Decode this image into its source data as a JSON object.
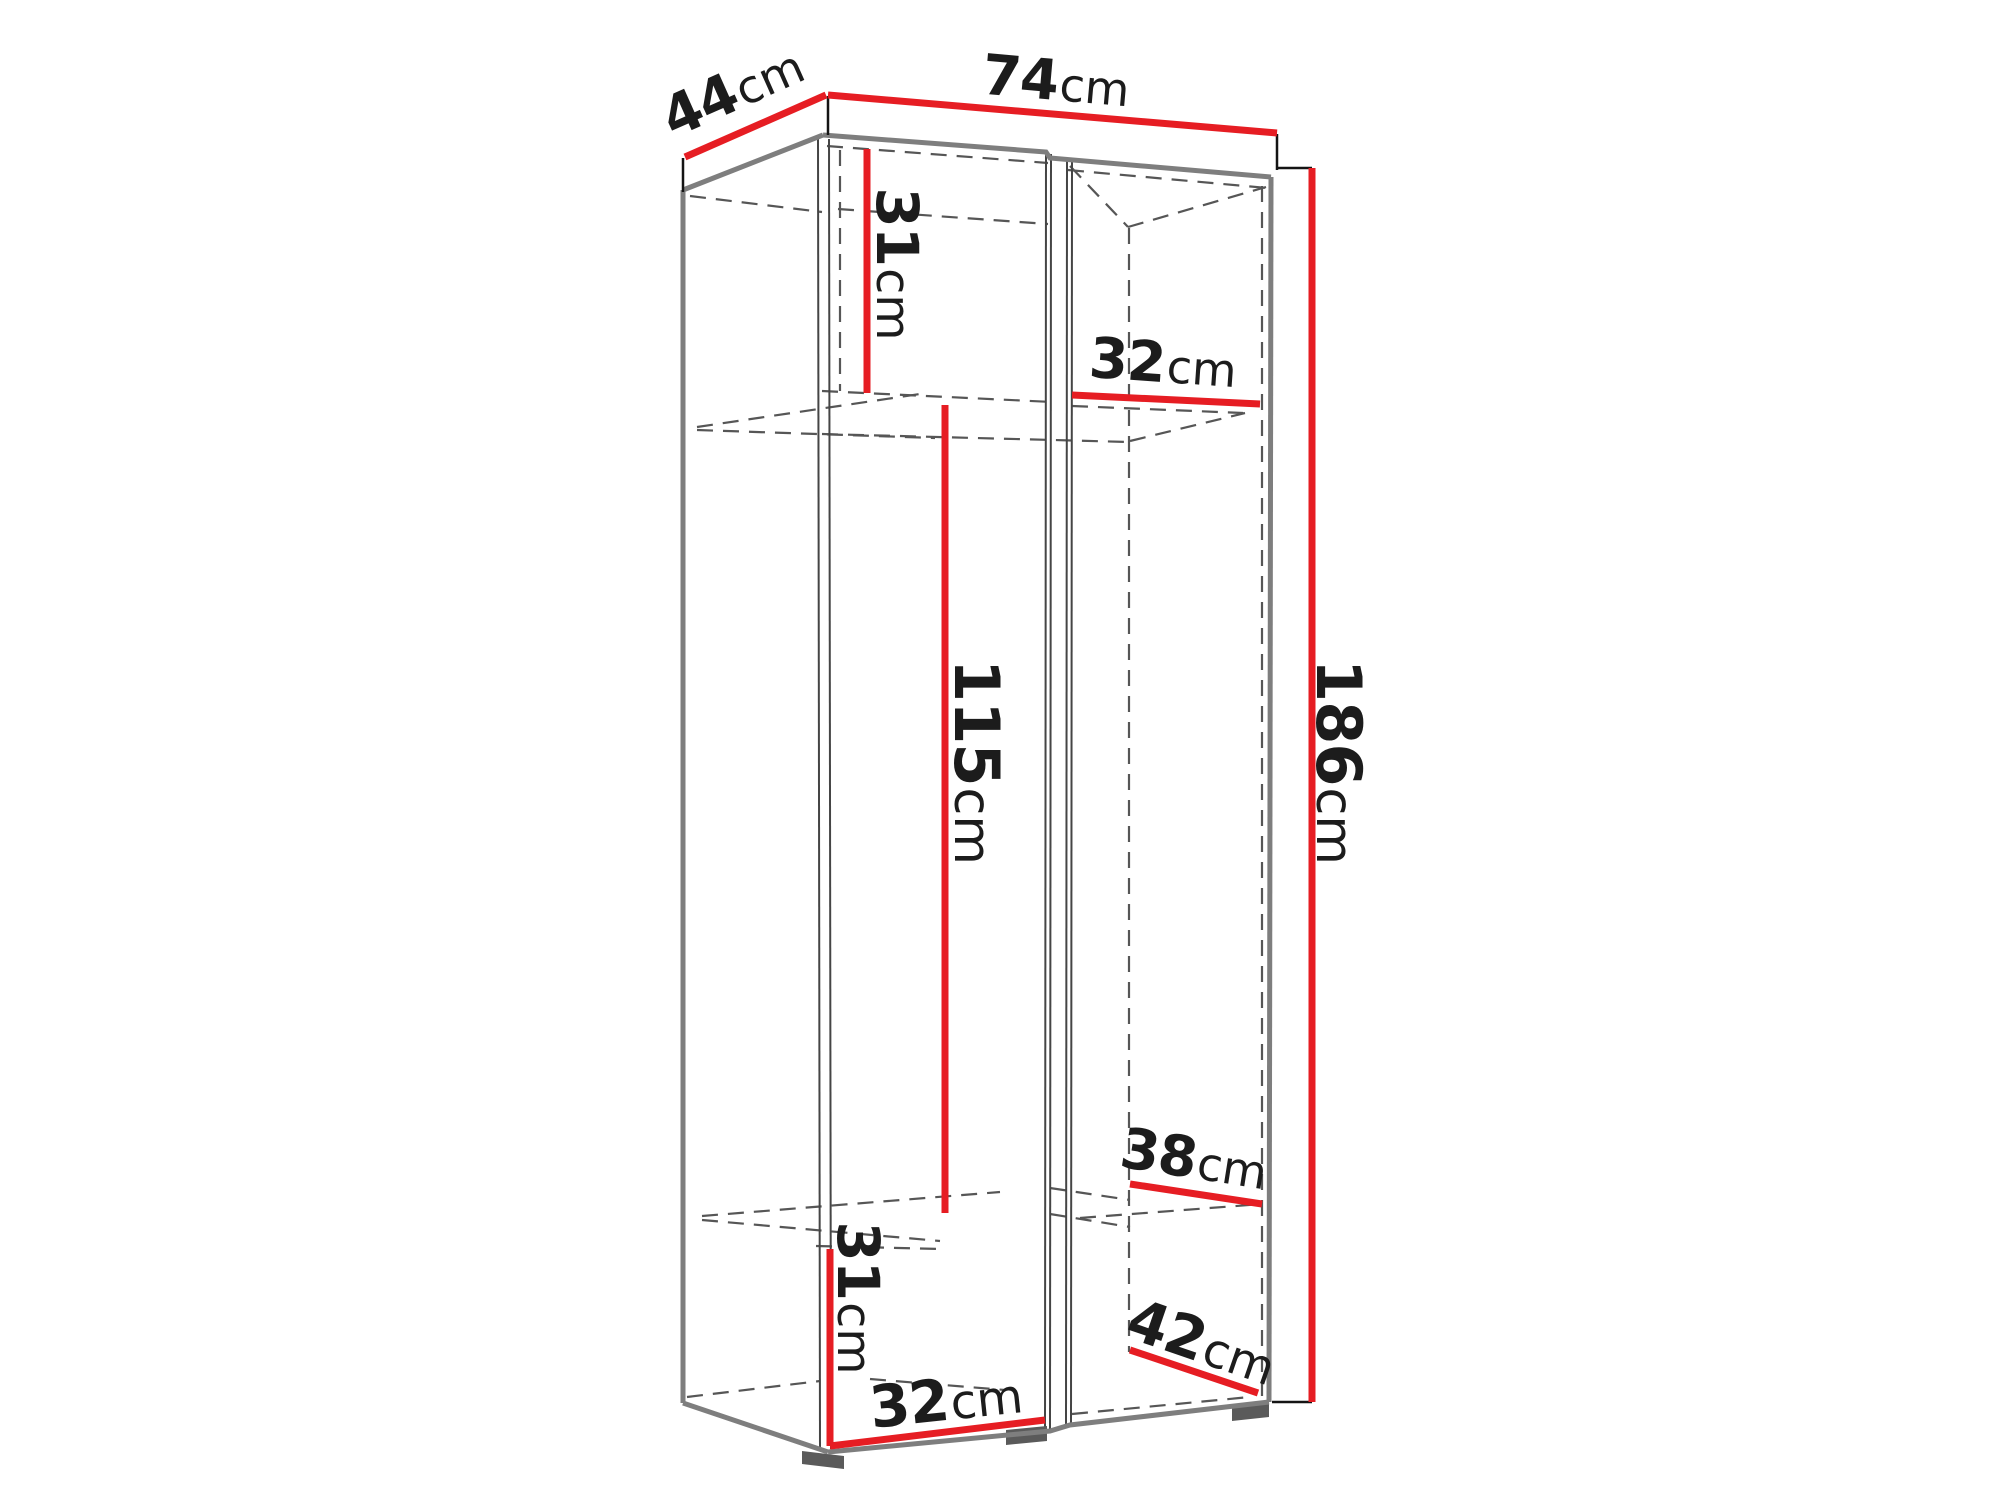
{
  "diagram": {
    "name": "wardrobe-dimensions-diagram",
    "unit": "cm",
    "colors": {
      "dimension_line": "#e61d23",
      "outline_gray": "#7e7e7e",
      "dashed_interior": "#565656",
      "label_text": "#1c1c1c",
      "tick_black": "#141414"
    },
    "dimensions": [
      {
        "id": "depth-top",
        "value": "44",
        "unit": "cm"
      },
      {
        "id": "width-top",
        "value": "74",
        "unit": "cm"
      },
      {
        "id": "upper-compartment-height",
        "value": "31",
        "unit": "cm"
      },
      {
        "id": "upper-shelf-width",
        "value": "32",
        "unit": "cm"
      },
      {
        "id": "middle-section-height",
        "value": "115",
        "unit": "cm"
      },
      {
        "id": "total-height",
        "value": "186",
        "unit": "cm"
      },
      {
        "id": "lower-shelf-depth",
        "value": "38",
        "unit": "cm"
      },
      {
        "id": "lower-compartment-height",
        "value": "31",
        "unit": "cm"
      },
      {
        "id": "lower-shelf-width",
        "value": "32",
        "unit": "cm"
      },
      {
        "id": "bottom-depth",
        "value": "42",
        "unit": "cm"
      }
    ]
  }
}
